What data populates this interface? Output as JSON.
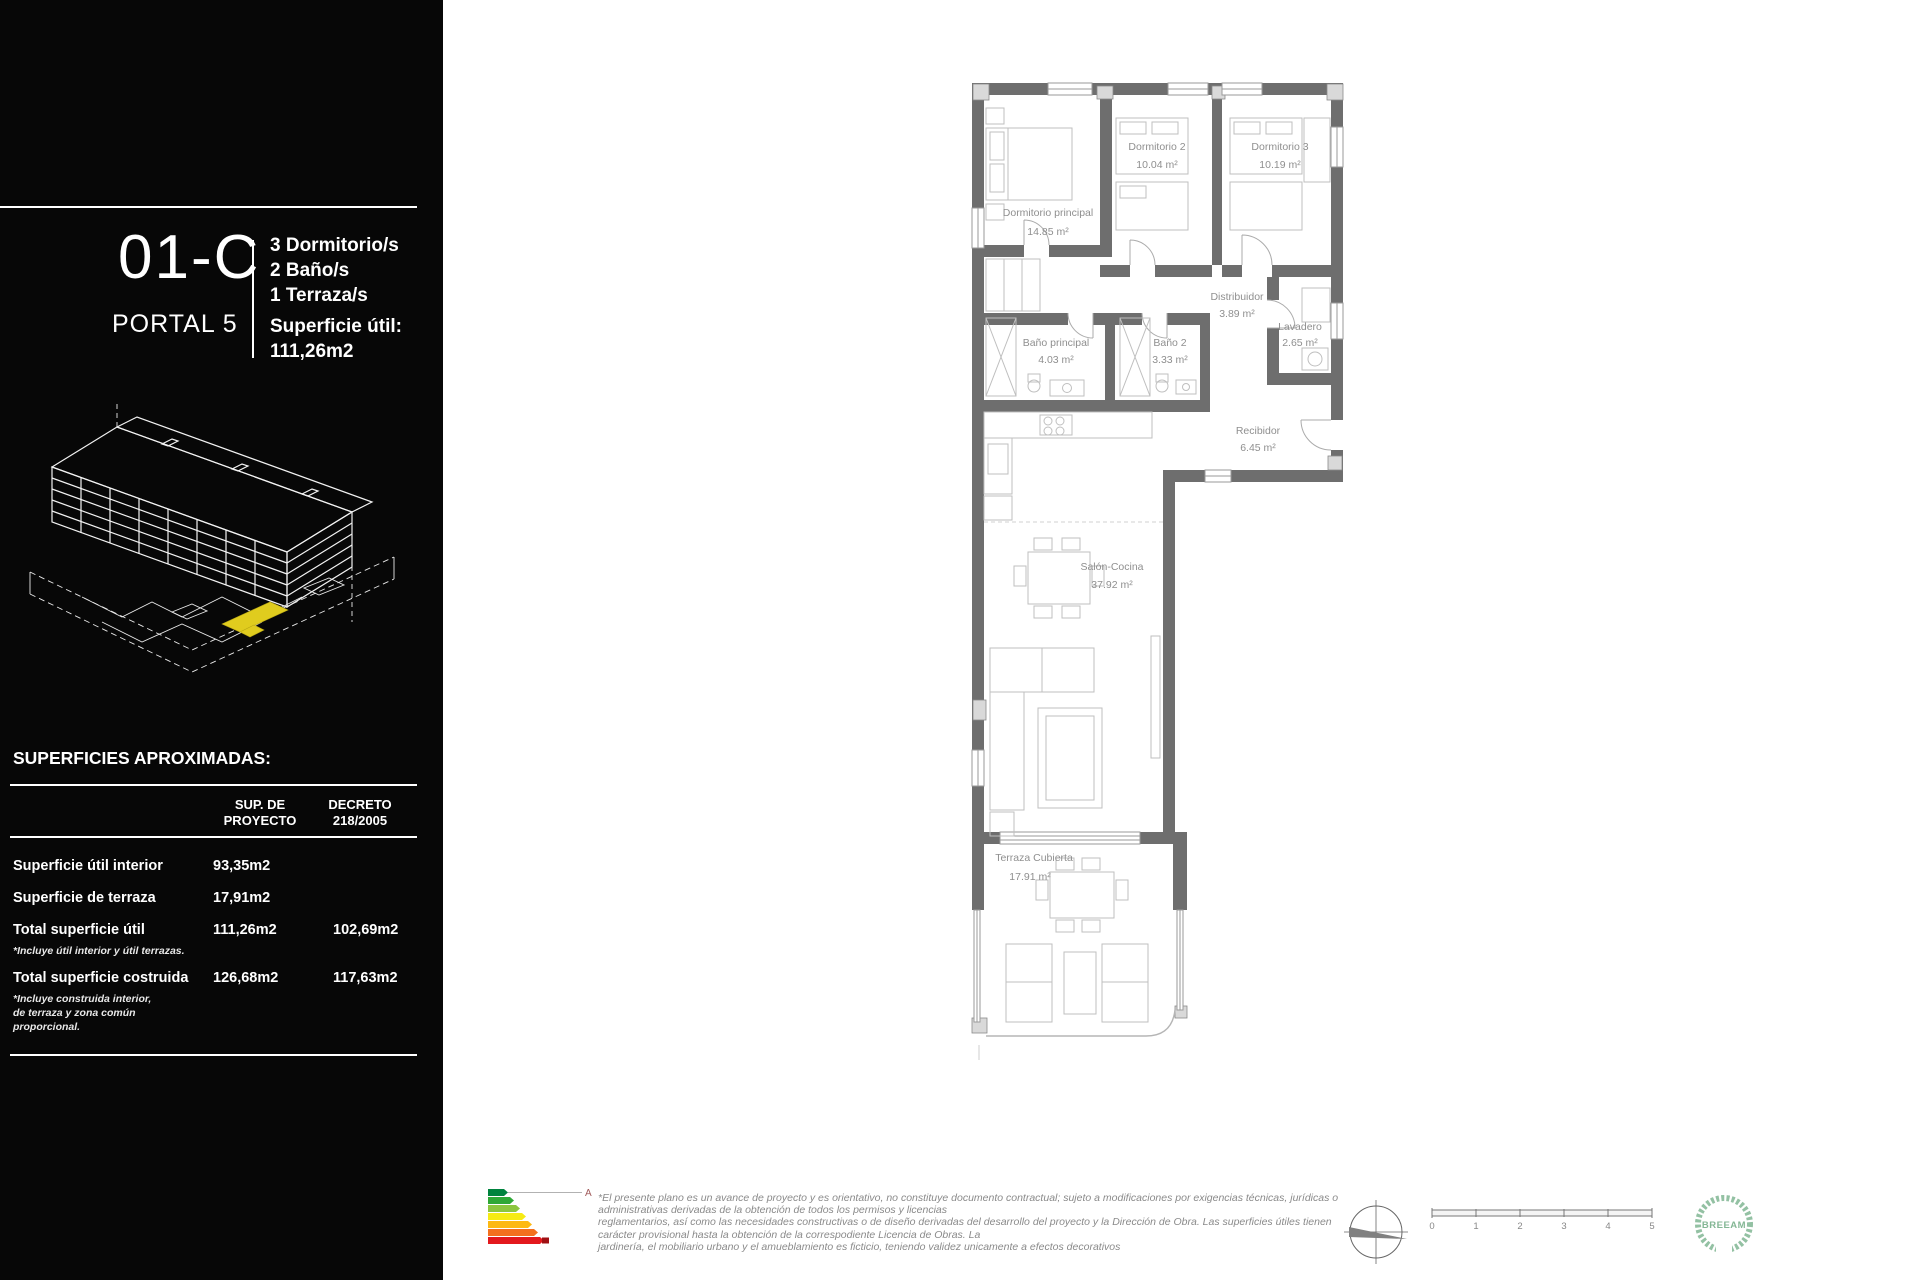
{
  "sidebar": {
    "unit_code": "01-C",
    "portal": "PORTAL 5",
    "features": [
      "3 Dormitorio/s",
      "2 Baño/s",
      "1 Terraza/s"
    ],
    "surface_label": "Superficie útil:",
    "surface_value": "111,26m2",
    "table": {
      "title": "SUPERFICIES APROXIMADAS:",
      "headers": {
        "col1_line1": "SUP. DE",
        "col1_line2": "PROYECTO",
        "col2_line1": "DECRETO",
        "col2_line2": "218/2005"
      },
      "rows": [
        {
          "label": "Superficie útil interior",
          "proyecto": "93,35m2",
          "decreto": ""
        },
        {
          "label": "Superficie de terraza",
          "proyecto": "17,91m2",
          "decreto": ""
        },
        {
          "label": "Total superficie útil",
          "proyecto": "111,26m2",
          "decreto": "102,69m2",
          "note": "*Incluye útil interior y útil terrazas."
        },
        {
          "label": "Total superficie costruida",
          "proyecto": "126,68m2",
          "decreto": "117,63m2",
          "note": "*Incluye construida interior, de terraza y zona común proporcional."
        }
      ]
    },
    "highlight_color": "#e0cc1e"
  },
  "plan": {
    "rooms": [
      {
        "name": "Dormitorio principal",
        "area": "14.85 m²"
      },
      {
        "name": "Dormitorio 2",
        "area": "10.04 m²"
      },
      {
        "name": "Dormitorio 3",
        "area": "10.19 m²"
      },
      {
        "name": "Distribuidor",
        "area": "3.89 m²"
      },
      {
        "name": "Lavadero",
        "area": "2.65 m²"
      },
      {
        "name": "Baño principal",
        "area": "4.03 m²"
      },
      {
        "name": "Baño 2",
        "area": "3.33 m²"
      },
      {
        "name": "Recibidor",
        "area": "6.45 m²"
      },
      {
        "name": "Salón-Cocina",
        "area": "37.92 m²"
      },
      {
        "name": "Terraza Cubierta",
        "area": "17.91 m²"
      }
    ],
    "wall_color": "#6e6e6e"
  },
  "footer": {
    "energy_rating": "A",
    "disclaimer_lines": [
      "*El presente plano es un avance de proyecto y es orientativo, no constituye documento contractual; sujeto a modificaciones por exigencias técnicas, jurídicas o",
      "administrativas derivadas de la obtención de todos los permisos y licencias",
      "reglamentarios, así como las necesidades constructivas o de diseño derivadas del desarrollo del proyecto y la Dirección de Obra. Las superficies útiles tienen",
      "carácter provisional hasta la obtención de la correspodiente Licencia de Obras. La",
      "jardinería, el mobiliario urbano y el amueblamiento es ficticio, teniendo validez unicamente a efectos decorativos"
    ],
    "scale_ticks": [
      "0",
      "1",
      "2",
      "3",
      "4",
      "5"
    ],
    "breeam_label": "BREEAM"
  }
}
